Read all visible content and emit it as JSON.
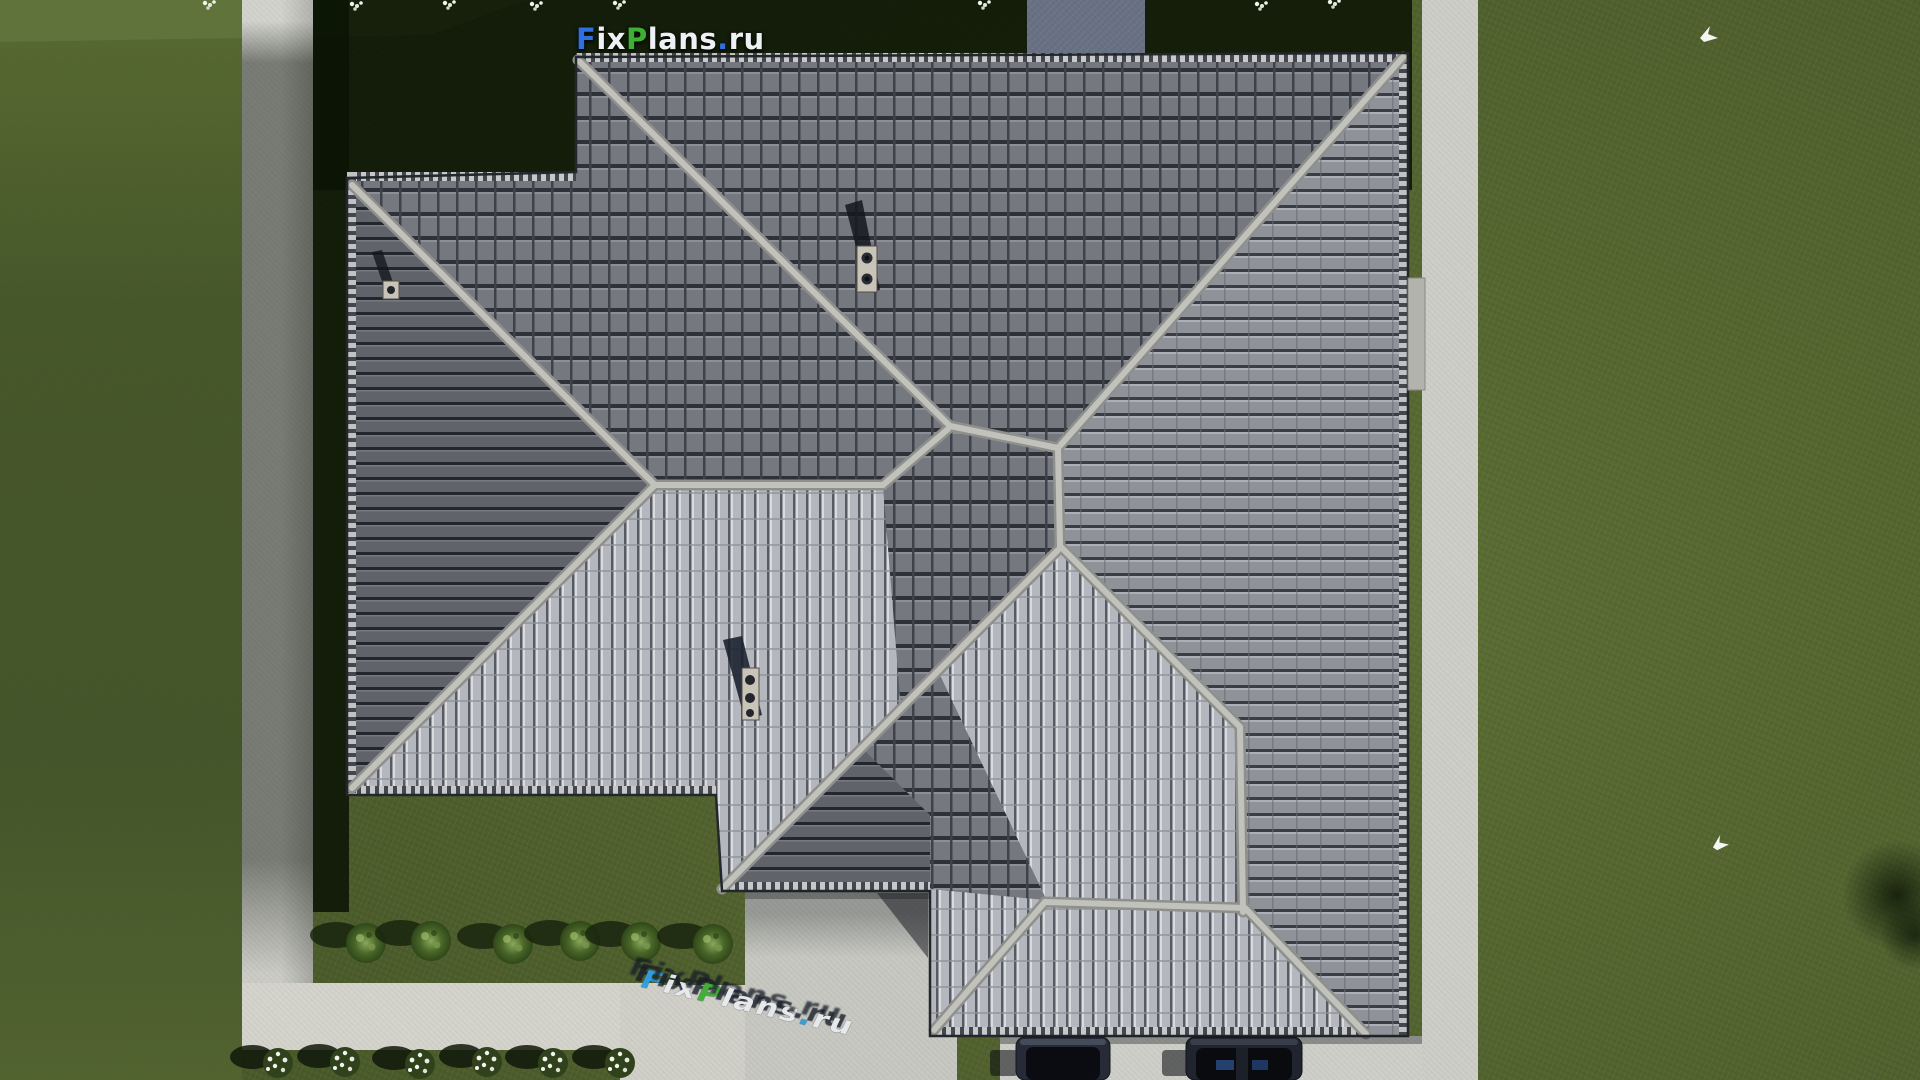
{
  "meta": {
    "description": "Aerial top-down 3D architectural render of a single-family house with a gray tiled pinwheel hip roof on a green lawn",
    "site": "FixPlans.ru"
  },
  "logo": {
    "text": "FixPlans.ru",
    "segments": [
      {
        "text": "F",
        "color": "#2f6fe0"
      },
      {
        "text": "ix",
        "color": "#eef0f3"
      },
      {
        "text": "P",
        "color": "#3fae34"
      },
      {
        "text": "lans",
        "color": "#eef0f3"
      },
      {
        "text": ".",
        "color": "#2f6fe0"
      },
      {
        "text": "ru",
        "color": "#eef0f3"
      }
    ]
  },
  "watermark": {
    "text": "FixPlans.ru",
    "segments": [
      {
        "text": "F",
        "color": "#2f9fe0"
      },
      {
        "text": "ix",
        "color": "#e8eaee"
      },
      {
        "text": "P",
        "color": "#3fae34"
      },
      {
        "text": "lans",
        "color": "#e8eaee"
      },
      {
        "text": ".",
        "color": "#2f9fe0"
      },
      {
        "text": "ru",
        "color": "#e8eaee"
      }
    ]
  },
  "scene": {
    "setting": "Top-down aerial view; sunlight from lower-right, shadows cast to upper-left",
    "grass_color": "#52632f",
    "grass_shadow_color": "#14210d",
    "concrete_color": "#cbccc5",
    "roof_dark_tile_color": "#75787f",
    "roof_medium_tile_color": "#8f9299",
    "roof_light_tile_color": "#b4b7bd",
    "ridge_color": "#c2c2bd",
    "chimney_plate_color": "#c9c4b8",
    "chimneys": 3,
    "chimney_vent_circles": [
      2,
      1,
      3
    ],
    "green_bushes": 6,
    "white_flower_bushes": 6,
    "white_flower_clusters_top": 8,
    "parked_cars": 2,
    "car_color": "#232833",
    "white_birds": 2
  }
}
